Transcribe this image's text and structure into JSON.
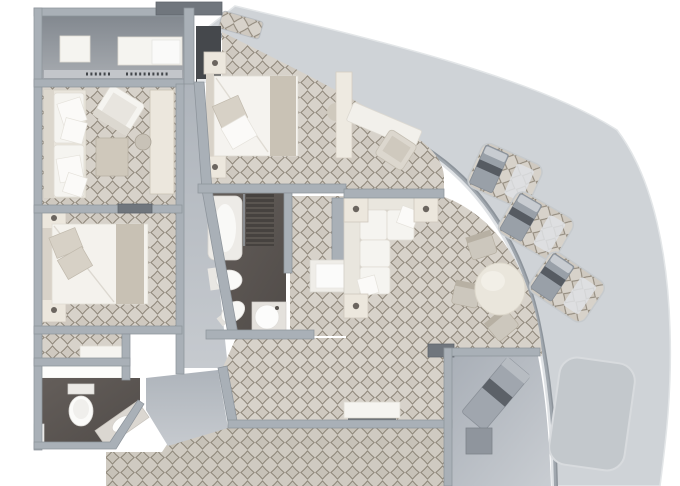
{
  "image_type": "architectural_floor_plan",
  "subject": "Top-down 3D rendered floor plan of a curved-hull ship suite; no text labels visible in the image",
  "palette": {
    "background": "#ffffff",
    "carpet_base": "#d7d2ca",
    "carpet_lattice": "#8e8679",
    "wall": "#a9b0b7",
    "wall_dark": "#70767d",
    "balcony_deck": "#cfd3d7",
    "dark_bath_floor": "#5b5551",
    "gray_floor": "#b6bbc1",
    "closet_floor": "#8b9097",
    "terrace_floor": "#b3b9c0",
    "furniture_white": "#f5f4f0",
    "furniture_cream": "#ece7dd",
    "furniture_beige": "#c9c2b5",
    "lounger_gray": "#9aa1a9",
    "lounger_stripe": "#575c63",
    "spa_pad": "#c3c8cc",
    "entry_dark": "#45484c"
  },
  "rooms": [
    {
      "id": "wardrobe-room",
      "name": "entry wardrobe / closet room",
      "floor": "gray",
      "furniture": [
        "storage-box",
        "shelf-unit",
        "hanging-rail"
      ]
    },
    {
      "id": "sitting-room",
      "name": "sitting room",
      "floor": "carpet",
      "furniture": [
        "sofa",
        "armchair",
        "ottoman-table",
        "vanity-counter",
        "stool"
      ]
    },
    {
      "id": "bedroom-2",
      "name": "second bedroom",
      "floor": "carpet",
      "furniture": [
        "double-bed",
        "nightstand",
        "nightstand",
        "pillows"
      ]
    },
    {
      "id": "bathroom-2",
      "name": "guest bathroom",
      "floor": "dark",
      "furniture": [
        "toilet",
        "vanity-sink",
        "lit-counter"
      ]
    },
    {
      "id": "master-bedroom",
      "name": "master bedroom",
      "floor": "carpet",
      "furniture": [
        "king-bed",
        "nightstand",
        "nightstand",
        "desk",
        "desk-chair",
        "closet",
        "stool"
      ]
    },
    {
      "id": "master-bathroom",
      "name": "master bathroom",
      "floor": "dark",
      "furniture": [
        "bathtub",
        "shower",
        "toilet",
        "bidet",
        "round-sink"
      ]
    },
    {
      "id": "dressing-hall",
      "name": "dressing hall",
      "floor": "carpet",
      "furniture": [
        "closet-shelves"
      ]
    },
    {
      "id": "living-dining-room",
      "name": "living / dining room",
      "floor": "carpet",
      "furniture": [
        "l-shaped-sofa",
        "end-tables",
        "round-dining-table",
        "dining-chairs",
        "bench-sideboard"
      ]
    },
    {
      "id": "foyer-corridor",
      "name": "entry corridor and foyer",
      "floor": "gray",
      "furniture": []
    },
    {
      "id": "terrace-room",
      "name": "private terrace room",
      "floor": "gray",
      "furniture": [
        "lounge-chair",
        "side-table"
      ]
    }
  ],
  "balcony": {
    "name": "curved hull balcony deck",
    "items": [
      "lounger-mat",
      "lounger-mat",
      "lounger-mat",
      "spa-pad",
      "deck-mat-patch"
    ]
  }
}
